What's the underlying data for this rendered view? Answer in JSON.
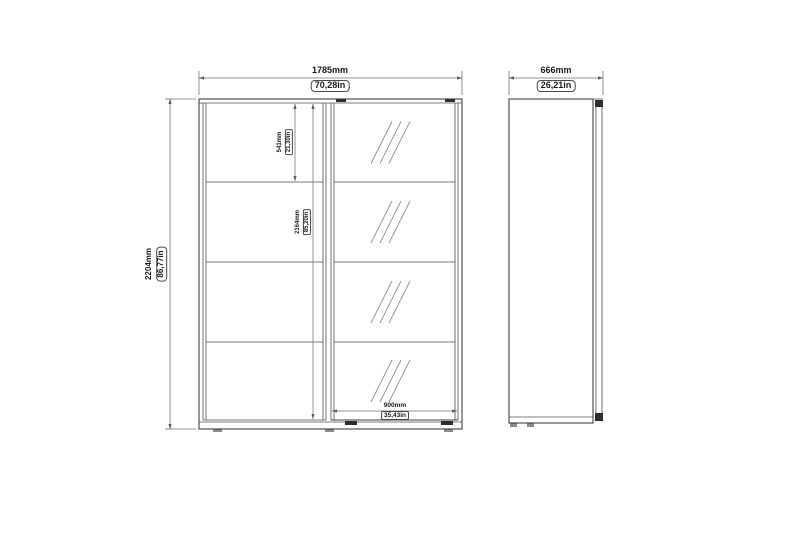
{
  "drawing_type": "wardrobe-technical-drawing",
  "colors": {
    "background": "#ffffff",
    "object_line": "#3f3f3f",
    "dimension_line": "#6f6f6f",
    "text": "#1a1a1a"
  },
  "dimensions": {
    "front_width": {
      "mm": "1785mm",
      "inches": "70,28in"
    },
    "height": {
      "mm": "2204mm",
      "inches": "86,77in"
    },
    "top_panel_height": {
      "mm": "541mm",
      "inches": "21,30in"
    },
    "door_height": {
      "mm": "2164mm",
      "inches": "85,20in"
    },
    "mirror_door_width": {
      "mm": "900mm",
      "inches": "35,43in"
    },
    "depth": {
      "mm": "666mm",
      "inches": "26,21in"
    }
  }
}
